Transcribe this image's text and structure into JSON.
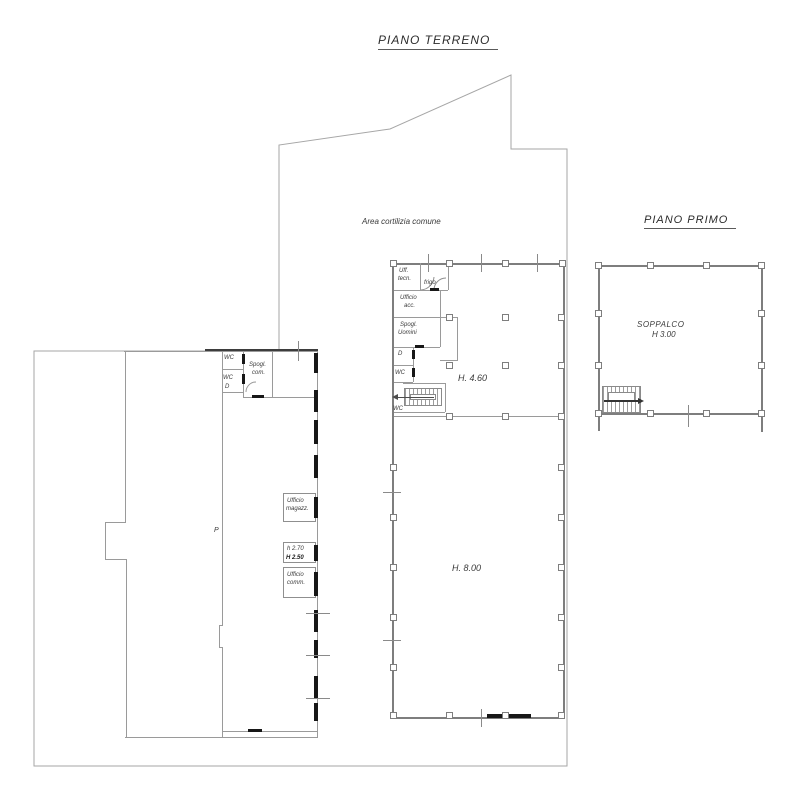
{
  "drawing": {
    "title_ground": "PIANO TERRENO",
    "title_first": "PIANO PRIMO",
    "courtyard_label": "Area cortilizia comune"
  },
  "ground_floor": {
    "main_hall": {
      "height_front": "H. 4.60",
      "height_back": "H. 8.00"
    },
    "rooms": {
      "uff_tecn_1": "Uff.",
      "uff_tecn_2": "tecn.",
      "frigo": "frigo",
      "ufficio_acc_1": "Ufficio",
      "ufficio_acc_2": "acc.",
      "spogl_1": "Spogl.",
      "spogl_2": "Uomini",
      "d": "D",
      "wc": "WC",
      "stair_wc": "WC"
    },
    "left_wing": {
      "wc1": "WC",
      "wc2": "WC",
      "d": "D",
      "spogl_1": "Spogl.",
      "spogl_2": "com.",
      "box1_line1": "Ufficio",
      "box1_line2": "magazz.",
      "box2_line1": "h 2.70",
      "box2_line2": "H 2.50",
      "box3_line1": "Ufficio",
      "box3_line2": "comm.",
      "p_mark": "P"
    }
  },
  "first_floor": {
    "label_1": "SOPPALCO",
    "label_2": "H 3.00"
  },
  "colors": {
    "wall": "#7e7e7e",
    "boundary": "#a6a6a6",
    "dark": "#171717",
    "text": "#3a3a3a"
  }
}
